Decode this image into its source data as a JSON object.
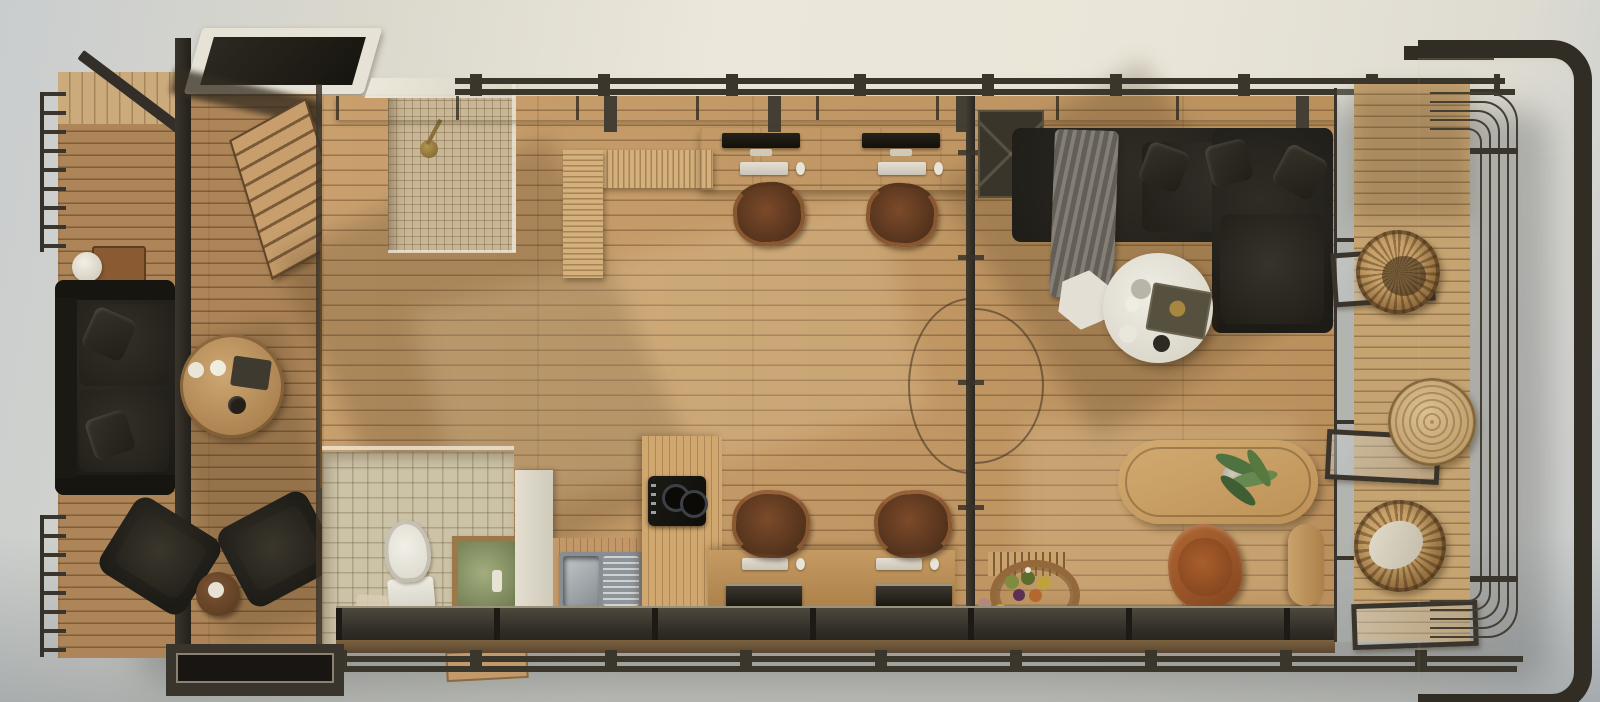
{
  "scene": {
    "title": "Top-down architectural render of a container tiny house with two decks",
    "view": "overhead floor plan, photorealistic 3D rendering",
    "text_visible": "none"
  },
  "palette": {
    "ground_warm": "#e9e5d8",
    "ground_cool": "#c2c7c9",
    "floor_wood": "#c49862",
    "deck_wood_left": "#ad8558",
    "deck_wood_right": "#c6a472",
    "steel_frame": "#312c24",
    "rail_metal": "#3b362c",
    "leather_black": "#24211b",
    "leather_brown": "#7c4a2a",
    "leather_cognac": "#a45c30",
    "white_surface": "#e9e6df",
    "stainless": "#aab0b4",
    "shower_tile": "#c9b694",
    "bath_tile": "#ccc2a8",
    "counter_wood": "#d2ac78",
    "rattan": "#a37c48",
    "plant_green": "#4f7340",
    "brass_fixture": "#93763f"
  },
  "rooms": {
    "deck_left": "west deck lounge",
    "shower_room": "shower room",
    "bathroom": "bathroom",
    "kitchen": "kitchen",
    "studio": "main studio with double workstations",
    "living_room": "living room",
    "dining_nook": "dining nook",
    "deck_right": "east deck with curved railing"
  },
  "furniture": {
    "left_sofa": "black leather three-seat sofa",
    "console_lamp": "wood console with sphere lamp",
    "side_table": "round wooden side table with decor",
    "armchair_left": "black leather armchair",
    "armchair_right": "black leather armchair",
    "deck_stool": "round wooden stool",
    "stairs": "exterior wooden stair",
    "storage_cabinet": "wooden storage cabinet",
    "skylight": "roof skylight panel",
    "shower_head": "brass rain shower head",
    "toilet": "toilet",
    "vanity": "stone-top vanity",
    "fridge": "tall white cabinet / refrigerator",
    "sink": "stainless double sink with drainboard",
    "cooktop": "two-burner black cooktop on wood island",
    "l_counter": "L-shaped slatted wood counter",
    "desk_north": "double workstation desk at north window",
    "desk_south": "double workstation desk at south window",
    "office_chair": "brown leather swivel chair with copper frame",
    "monitor": "desktop monitor",
    "keyboard": "white keyboard",
    "mouse": "white mouse",
    "divider": "steel-framed glass partition with pivot door",
    "wardrobe": "dark storage unit",
    "sectional_sofa": "black leather L-sectional sofa",
    "throw": "grey throw blanket",
    "coffee_table": "round white coffee table with tray and cups",
    "pouf": "white hexagonal side pouf",
    "dining_table": "oval wooden dining table",
    "plant": "potted green plant",
    "lounge_chair": "cognac leather lounge chair",
    "bench": "wooden bench",
    "fruit_tray": "rattan tray with fruit",
    "wicker_chair_north": "round rattan lounge chair",
    "wicker_table": "round rattan table",
    "wicker_chair_south": "round rattan chair with white cushion",
    "railing_left": "metal baluster railing",
    "railing_right": "curved horizontal-bar railing",
    "frame_right": "heavy steel corner frame",
    "rails_top": "double roof rails with ties",
    "rails_bottom": "double base rails with ties",
    "entry_door": "wood-framed glass entry door",
    "glass_doors_right": "open glass door panels",
    "platform": "dark entry step platform",
    "step": "small wooden step"
  }
}
